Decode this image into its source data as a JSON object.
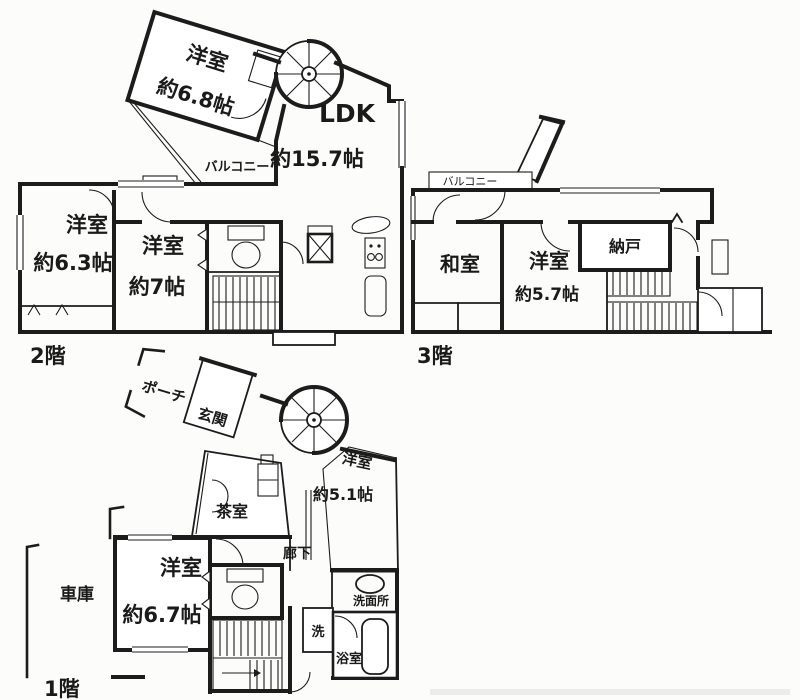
{
  "page": {
    "background": "#fcfcfa",
    "ink": "#1c1c1c"
  },
  "floors": {
    "f2": {
      "label": "2階",
      "rooms": {
        "yoshitsu68": {
          "name": "洋室",
          "size": "約6.8帖"
        },
        "balcony": {
          "name": "バルコニー"
        },
        "ldk": {
          "name": "LDK",
          "size": "約15.7帖"
        },
        "yoshitsu63": {
          "name": "洋室",
          "size": "約6.3帖"
        },
        "yoshitsu7": {
          "name": "洋室",
          "size": "約7帖"
        }
      }
    },
    "f3": {
      "label": "3階",
      "rooms": {
        "balcony": {
          "name": "バルコニー"
        },
        "washitsu": {
          "name": "和室"
        },
        "yoshitsu57": {
          "name": "洋室",
          "size": "約5.7帖"
        },
        "nando": {
          "name": "納戸"
        }
      }
    },
    "f1": {
      "label": "1階",
      "rooms": {
        "porch": {
          "name": "ポーチ"
        },
        "genkan": {
          "name": "玄関"
        },
        "chashitsu": {
          "name": "茶室"
        },
        "yoshitsu51": {
          "name": "洋室",
          "size": "約5.1帖"
        },
        "rouka": {
          "name": "廊下"
        },
        "yoshitsu67": {
          "name": "洋室",
          "size": "約6.7帖"
        },
        "garage": {
          "name": "車庫"
        },
        "laundry": {
          "name": "洗"
        },
        "senmenjo": {
          "name": "洗面所"
        },
        "bathroom": {
          "name": "浴室"
        }
      }
    }
  }
}
